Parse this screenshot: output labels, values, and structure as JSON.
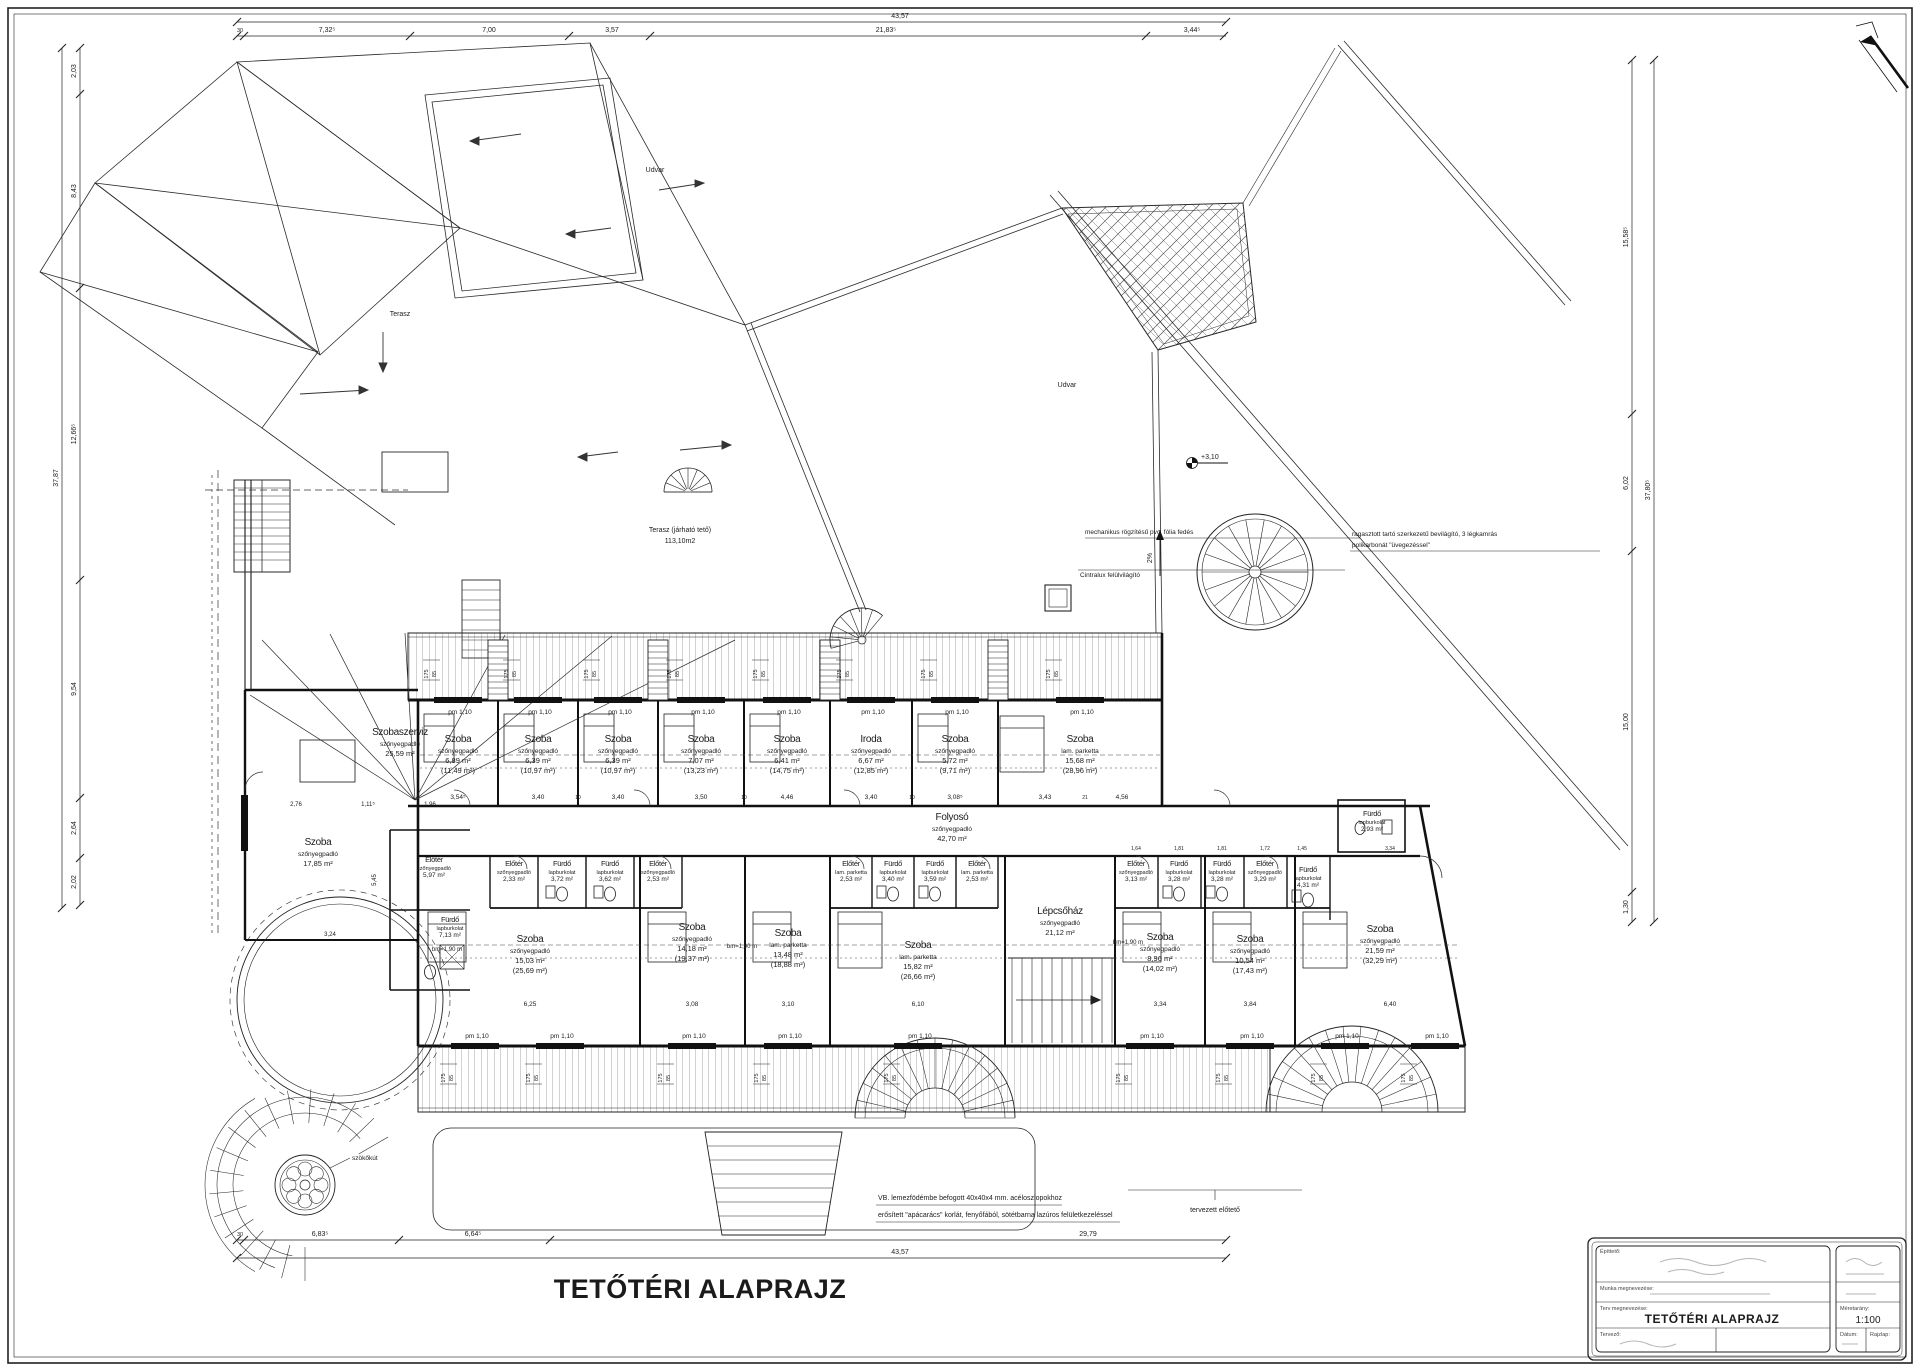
{
  "title": "TETŐTÉRI ALAPRAJZ",
  "title_block": {
    "client_label": "Építtető:",
    "work_label": "Munka megnevezése:",
    "drawing_label": "Terv megnevezése:",
    "drawing_name": "TETŐTÉRI ALAPRAJZ",
    "designer_label": "Tervező:",
    "scale_label": "Méretarány:",
    "scale_value": "1:100",
    "date_label": "Dátum:",
    "sheet_label": "Rajzlap:"
  },
  "window": {
    "label": "pm 1,10",
    "tag_a": "175",
    "tag_b": "85"
  },
  "rooms": [
    {
      "n": "Szoba",
      "f": "szőnyegpadló",
      "a": "6,89 m²",
      "t": "(11,49 m²)",
      "x": 458,
      "y": 742
    },
    {
      "n": "Szoba",
      "f": "szőnyegpadló",
      "a": "6,39 m²",
      "t": "(10,97 m²)",
      "x": 538,
      "y": 742
    },
    {
      "n": "Szoba",
      "f": "szőnyegpadló",
      "a": "6,39 m²",
      "t": "(10,97 m²)",
      "x": 618,
      "y": 742
    },
    {
      "n": "Szoba",
      "f": "szőnyegpadló",
      "a": "7,07 m²",
      "t": "(13,23 m²)",
      "x": 701,
      "y": 742
    },
    {
      "n": "Szoba",
      "f": "szőnyegpadló",
      "a": "6,41 m²",
      "t": "(14,75 m²)",
      "x": 787,
      "y": 742
    },
    {
      "n": "Iroda",
      "f": "szőnyegpadló",
      "a": "6,67 m²",
      "t": "(12,85 m²)",
      "x": 871,
      "y": 742
    },
    {
      "n": "Szoba",
      "f": "szőnyegpadló",
      "a": "5,72 m²",
      "t": "(9,71 m²)",
      "x": 955,
      "y": 742
    },
    {
      "n": "Szoba",
      "f": "lam. parketta",
      "a": "15,68 m²",
      "t": "(28,96 m²)",
      "x": 1080,
      "y": 742
    },
    {
      "n": "Folyosó",
      "f": "szőnyegpadló",
      "a": "42,70 m²",
      "x": 952,
      "y": 820
    },
    {
      "n": "Szobaszerviz",
      "f": "szőnyegpadló",
      "a": "25,59 m²",
      "x": 400,
      "y": 735
    },
    {
      "n": "Szoba",
      "f": "szőnyegpadló",
      "a": "17,85 m²",
      "x": 318,
      "y": 845
    },
    {
      "n": "Előtér",
      "f": "szőnyegpadló",
      "a": "5,97 m²",
      "x": 434,
      "y": 862,
      "sm": true
    },
    {
      "n": "Fürdő",
      "f": "lapburkolat",
      "a": "7,13 m²",
      "x": 450,
      "y": 922,
      "sm": true
    },
    {
      "n": "Előtér",
      "f": "szőnyegpadló",
      "a": "2,33 m²",
      "x": 514,
      "y": 866,
      "sm": true
    },
    {
      "n": "Fürdő",
      "f": "lapburkolat",
      "a": "3,72 m²",
      "x": 562,
      "y": 866,
      "sm": true
    },
    {
      "n": "Fürdő",
      "f": "lapburkolat",
      "a": "3,62 m²",
      "x": 610,
      "y": 866,
      "sm": true
    },
    {
      "n": "Előtér",
      "f": "szőnyegpadló",
      "a": "2,53 m²",
      "x": 658,
      "y": 866,
      "sm": true
    },
    {
      "n": "Előtér",
      "f": "lam. parketta",
      "a": "2,53 m²",
      "x": 851,
      "y": 866,
      "sm": true
    },
    {
      "n": "Fürdő",
      "f": "lapburkolat",
      "a": "3,40 m²",
      "x": 893,
      "y": 866,
      "sm": true
    },
    {
      "n": "Fürdő",
      "f": "lapburkolat",
      "a": "3,59 m²",
      "x": 935,
      "y": 866,
      "sm": true
    },
    {
      "n": "Előtér",
      "f": "lam. parketta",
      "a": "2,53 m²",
      "x": 977,
      "y": 866,
      "sm": true
    },
    {
      "n": "Előtér",
      "f": "szőnyegpadló",
      "a": "3,13 m²",
      "x": 1136,
      "y": 866,
      "sm": true
    },
    {
      "n": "Fürdő",
      "f": "lapburkolat",
      "a": "3,28 m²",
      "x": 1179,
      "y": 866,
      "sm": true
    },
    {
      "n": "Fürdő",
      "f": "lapburkolat",
      "a": "3,28 m²",
      "x": 1222,
      "y": 866,
      "sm": true
    },
    {
      "n": "Előtér",
      "f": "szőnyegpadló",
      "a": "3,29 m²",
      "x": 1265,
      "y": 866,
      "sm": true
    },
    {
      "n": "Fürdő",
      "f": "lapburkolat",
      "a": "4,31 m²",
      "x": 1308,
      "y": 872,
      "sm": true
    },
    {
      "n": "Fürdő",
      "f": "lapburkolat",
      "a": "2,93 m²",
      "x": 1372,
      "y": 816,
      "sm": true
    },
    {
      "n": "Szoba",
      "f": "szőnyegpadló",
      "a": "15,03 m²",
      "t": "(25,69 m²)",
      "x": 530,
      "y": 942
    },
    {
      "n": "Szoba",
      "f": "szőnyegpadló",
      "a": "14,18 m²",
      "t": "(19,37 m²)",
      "x": 692,
      "y": 930
    },
    {
      "n": "Szoba",
      "f": "lam. parketta",
      "a": "13,48 m²",
      "t": "(18,88 m²)",
      "x": 788,
      "y": 936
    },
    {
      "n": "Szoba",
      "f": "lam. parketta",
      "a": "15,82 m²",
      "t": "(26,66 m²)",
      "x": 918,
      "y": 948
    },
    {
      "n": "Lépcsőház",
      "f": "szőnyegpadló",
      "a": "21,12 m²",
      "x": 1060,
      "y": 914
    },
    {
      "n": "Szoba",
      "f": "szőnyegpadló",
      "a": "8,96 m²",
      "t": "(14,02 m²)",
      "x": 1160,
      "y": 940
    },
    {
      "n": "Szoba",
      "f": "szőnyegpadló",
      "a": "10,54 m²",
      "t": "(17,43 m²)",
      "x": 1250,
      "y": 942
    },
    {
      "n": "Szoba",
      "f": "szőnyegpadló",
      "a": "21,59 m²",
      "t": "(32,29 m²)",
      "x": 1380,
      "y": 932
    }
  ],
  "annotations": [
    {
      "t": "Terasz",
      "x": 400,
      "y": 316,
      "s": 7
    },
    {
      "t": "Udvar",
      "x": 655,
      "y": 172,
      "s": 7
    },
    {
      "t": "Udvar",
      "x": 1067,
      "y": 387,
      "s": 7
    },
    {
      "t": "Terasz (járható tető)",
      "x": 680,
      "y": 532,
      "s": 7
    },
    {
      "t": "113,10m2",
      "x": 680,
      "y": 543,
      "s": 7
    },
    {
      "t": "mechanikus rögzítésű pvc. fólia fedés",
      "x": 1085,
      "y": 534,
      "s": 6.5,
      "a": "start"
    },
    {
      "t": "2%",
      "x": 1152,
      "y": 558,
      "s": 7,
      "r": -90
    },
    {
      "t": "+3,10",
      "x": 1201,
      "y": 459,
      "s": 7,
      "a": "start"
    },
    {
      "t": "ragasztott tartó szerkezetű bevilágító, 3 légkamrás",
      "x": 1352,
      "y": 536,
      "s": 6.5,
      "a": "start"
    },
    {
      "t": "polikarbonát \"üvegezéssel\"",
      "x": 1352,
      "y": 547,
      "s": 6.5,
      "a": "start"
    },
    {
      "t": "Cintralux felülvilágító",
      "x": 1080,
      "y": 577,
      "s": 6.5,
      "a": "start"
    },
    {
      "t": "szökőkút",
      "x": 352,
      "y": 1160,
      "s": 6.5,
      "a": "start"
    },
    {
      "t": "VB. lemezfödémbe befogott 40x40x4 mm. acéloszlopokhoz",
      "x": 878,
      "y": 1200,
      "s": 7,
      "a": "start"
    },
    {
      "t": "erősített \"apácarács\" korlát, fenyőfából, sötétbarna lazúros felületkezeléssel",
      "x": 878,
      "y": 1217,
      "s": 7,
      "a": "start"
    },
    {
      "t": "tervezett előtető",
      "x": 1215,
      "y": 1212,
      "s": 7
    },
    {
      "t": "bm=1,90 m",
      "x": 447,
      "y": 951,
      "s": 6
    },
    {
      "t": "bm=1,90 m",
      "x": 742,
      "y": 948,
      "s": 6
    },
    {
      "t": "bm=1,90 m",
      "x": 1128,
      "y": 944,
      "s": 6
    }
  ],
  "dimensions": [
    {
      "t": "43,57",
      "x": 900,
      "y": 18
    },
    {
      "t": "30",
      "x": 240,
      "y": 32,
      "s": 5.5
    },
    {
      "t": "7,32⁵",
      "x": 327,
      "y": 32
    },
    {
      "t": "7,00",
      "x": 489,
      "y": 32
    },
    {
      "t": "3,57",
      "x": 612,
      "y": 32
    },
    {
      "t": "21,83⁵",
      "x": 886,
      "y": 32
    },
    {
      "t": "3,44⁵",
      "x": 1192,
      "y": 32
    },
    {
      "t": "30",
      "x": 240,
      "y": 1236,
      "s": 5.5
    },
    {
      "t": "6,83⁵",
      "x": 320,
      "y": 1236
    },
    {
      "t": "6,64⁵",
      "x": 473,
      "y": 1236
    },
    {
      "t": "29,79",
      "x": 1088,
      "y": 1236
    },
    {
      "t": "43,57",
      "x": 900,
      "y": 1254
    },
    {
      "t": "2,03",
      "x": 76,
      "y": 71,
      "r": -90
    },
    {
      "t": "8,43",
      "x": 76,
      "y": 191,
      "r": -90
    },
    {
      "t": "12,66⁵",
      "x": 76,
      "y": 434,
      "r": -90
    },
    {
      "t": "9,54",
      "x": 76,
      "y": 689,
      "r": -90
    },
    {
      "t": "2,64",
      "x": 76,
      "y": 828,
      "r": -90
    },
    {
      "t": "2,02",
      "x": 76,
      "y": 882,
      "r": -90
    },
    {
      "t": "37,87",
      "x": 58,
      "y": 478,
      "r": -90
    },
    {
      "t": "15,58⁵",
      "x": 1628,
      "y": 237,
      "r": -90
    },
    {
      "t": "6,02",
      "x": 1628,
      "y": 483,
      "r": -90
    },
    {
      "t": "15,00",
      "x": 1628,
      "y": 722,
      "r": -90
    },
    {
      "t": "1,30",
      "x": 1628,
      "y": 907,
      "r": -90
    },
    {
      "t": "37,80⁵",
      "x": 1650,
      "y": 490,
      "r": -90
    },
    {
      "t": "3,54⁵",
      "x": 458,
      "y": 799,
      "s": 6.5
    },
    {
      "t": "3,40",
      "x": 538,
      "y": 799,
      "s": 6.5
    },
    {
      "t": "3,40",
      "x": 618,
      "y": 799,
      "s": 6.5
    },
    {
      "t": "3,50",
      "x": 701,
      "y": 799,
      "s": 6.5
    },
    {
      "t": "4,46",
      "x": 787,
      "y": 799,
      "s": 6.5
    },
    {
      "t": "3,40",
      "x": 871,
      "y": 799,
      "s": 6.5
    },
    {
      "t": "3,08⁵",
      "x": 955,
      "y": 799,
      "s": 6.5
    },
    {
      "t": "3,43",
      "x": 1045,
      "y": 799,
      "s": 6.5
    },
    {
      "t": "21",
      "x": 1085,
      "y": 799,
      "s": 5
    },
    {
      "t": "4,56",
      "x": 1122,
      "y": 799,
      "s": 6.5
    },
    {
      "t": "10",
      "x": 578,
      "y": 799,
      "s": 5
    },
    {
      "t": "10",
      "x": 744,
      "y": 799,
      "s": 5
    },
    {
      "t": "10",
      "x": 912,
      "y": 799,
      "s": 5
    },
    {
      "t": "6,25",
      "x": 530,
      "y": 1006,
      "s": 6.5
    },
    {
      "t": "3,08",
      "x": 692,
      "y": 1006,
      "s": 6.5
    },
    {
      "t": "3,10",
      "x": 788,
      "y": 1006,
      "s": 6.5
    },
    {
      "t": "6,10",
      "x": 918,
      "y": 1006,
      "s": 6.5
    },
    {
      "t": "3,34",
      "x": 1160,
      "y": 1006,
      "s": 6.5
    },
    {
      "t": "3,84",
      "x": 1250,
      "y": 1006,
      "s": 6.5
    },
    {
      "t": "6,40",
      "x": 1390,
      "y": 1006,
      "s": 6.5
    },
    {
      "t": "2,76",
      "x": 296,
      "y": 806,
      "s": 6
    },
    {
      "t": "1,11⁵",
      "x": 368,
      "y": 806,
      "s": 6
    },
    {
      "t": "1,96",
      "x": 430,
      "y": 806,
      "s": 6
    },
    {
      "t": "5,45",
      "x": 376,
      "y": 880,
      "s": 6,
      "r": -90
    },
    {
      "t": "3,24",
      "x": 330,
      "y": 936,
      "s": 6
    },
    {
      "t": "1,64",
      "x": 1136,
      "y": 850,
      "s": 5
    },
    {
      "t": "1,81",
      "x": 1179,
      "y": 850,
      "s": 5
    },
    {
      "t": "1,81",
      "x": 1222,
      "y": 850,
      "s": 5
    },
    {
      "t": "1,72",
      "x": 1265,
      "y": 850,
      "s": 5
    },
    {
      "t": "1,45",
      "x": 1302,
      "y": 850,
      "s": 5
    },
    {
      "t": "3,34",
      "x": 1390,
      "y": 850,
      "s": 5
    }
  ]
}
